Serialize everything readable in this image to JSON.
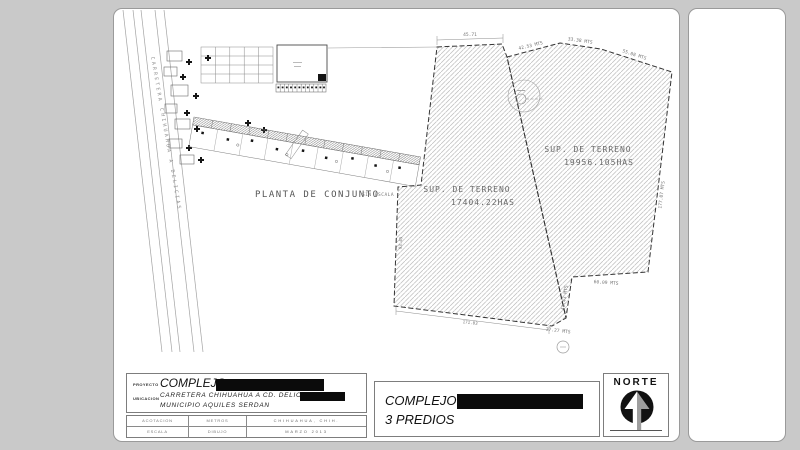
{
  "drawing": {
    "plan_title": "PLANTA DE CONJUNTO",
    "plan_scale_note": "SIN ESCALA",
    "road_label": "CARRETERA CHIHUAHUA A DELICIAS",
    "parcels": {
      "left": {
        "line1": "SUP. DE TERRENO",
        "line2": "17404.22HAS"
      },
      "right": {
        "line1": "SUP. DE TERRENO",
        "line2": "19956.105HAS"
      }
    },
    "dimensions": {
      "top_width": "45.71",
      "north_seg1": "42.53 MTS",
      "north_seg2": "33.38 MTS",
      "north_seg3": "55.08 MTS",
      "east_edge": "177.07 MTS",
      "south_right": "60.09 MTS",
      "between_short": "41.43 MTS",
      "south_notch": "27.27 MTS",
      "south_left": "171.03",
      "west_edge": "93.45"
    }
  },
  "title_block": {
    "proyecto_label": "PROYECTO",
    "proyecto_value": "COMPLEJO",
    "ubicacion_label": "UBICACION",
    "ubicacion_line1": "CARRETERA CHIHUAHUA A CD. DELICIAS",
    "ubicacion_line2": "MUNICIPIO AQUILES SERDAN",
    "meta": {
      "r1c1": "ACOTACION",
      "r1c2": "METROS",
      "r1c3": "CHIHUAHUA, CHIH.",
      "r2c1": "ESCALA",
      "r2c2": "DIBUJO",
      "r2c3": "MARZO 2013"
    },
    "sheet_title_line1": "COMPLEJO",
    "sheet_title_line2": "3 PREDIOS",
    "north_label": "NORTE"
  },
  "colors": {
    "page_bg": "#c9c9c9",
    "sheet": "#ffffff",
    "boundary": "#333333",
    "hatch": "#bcbcbc",
    "redaction": "#0b0b0b"
  }
}
